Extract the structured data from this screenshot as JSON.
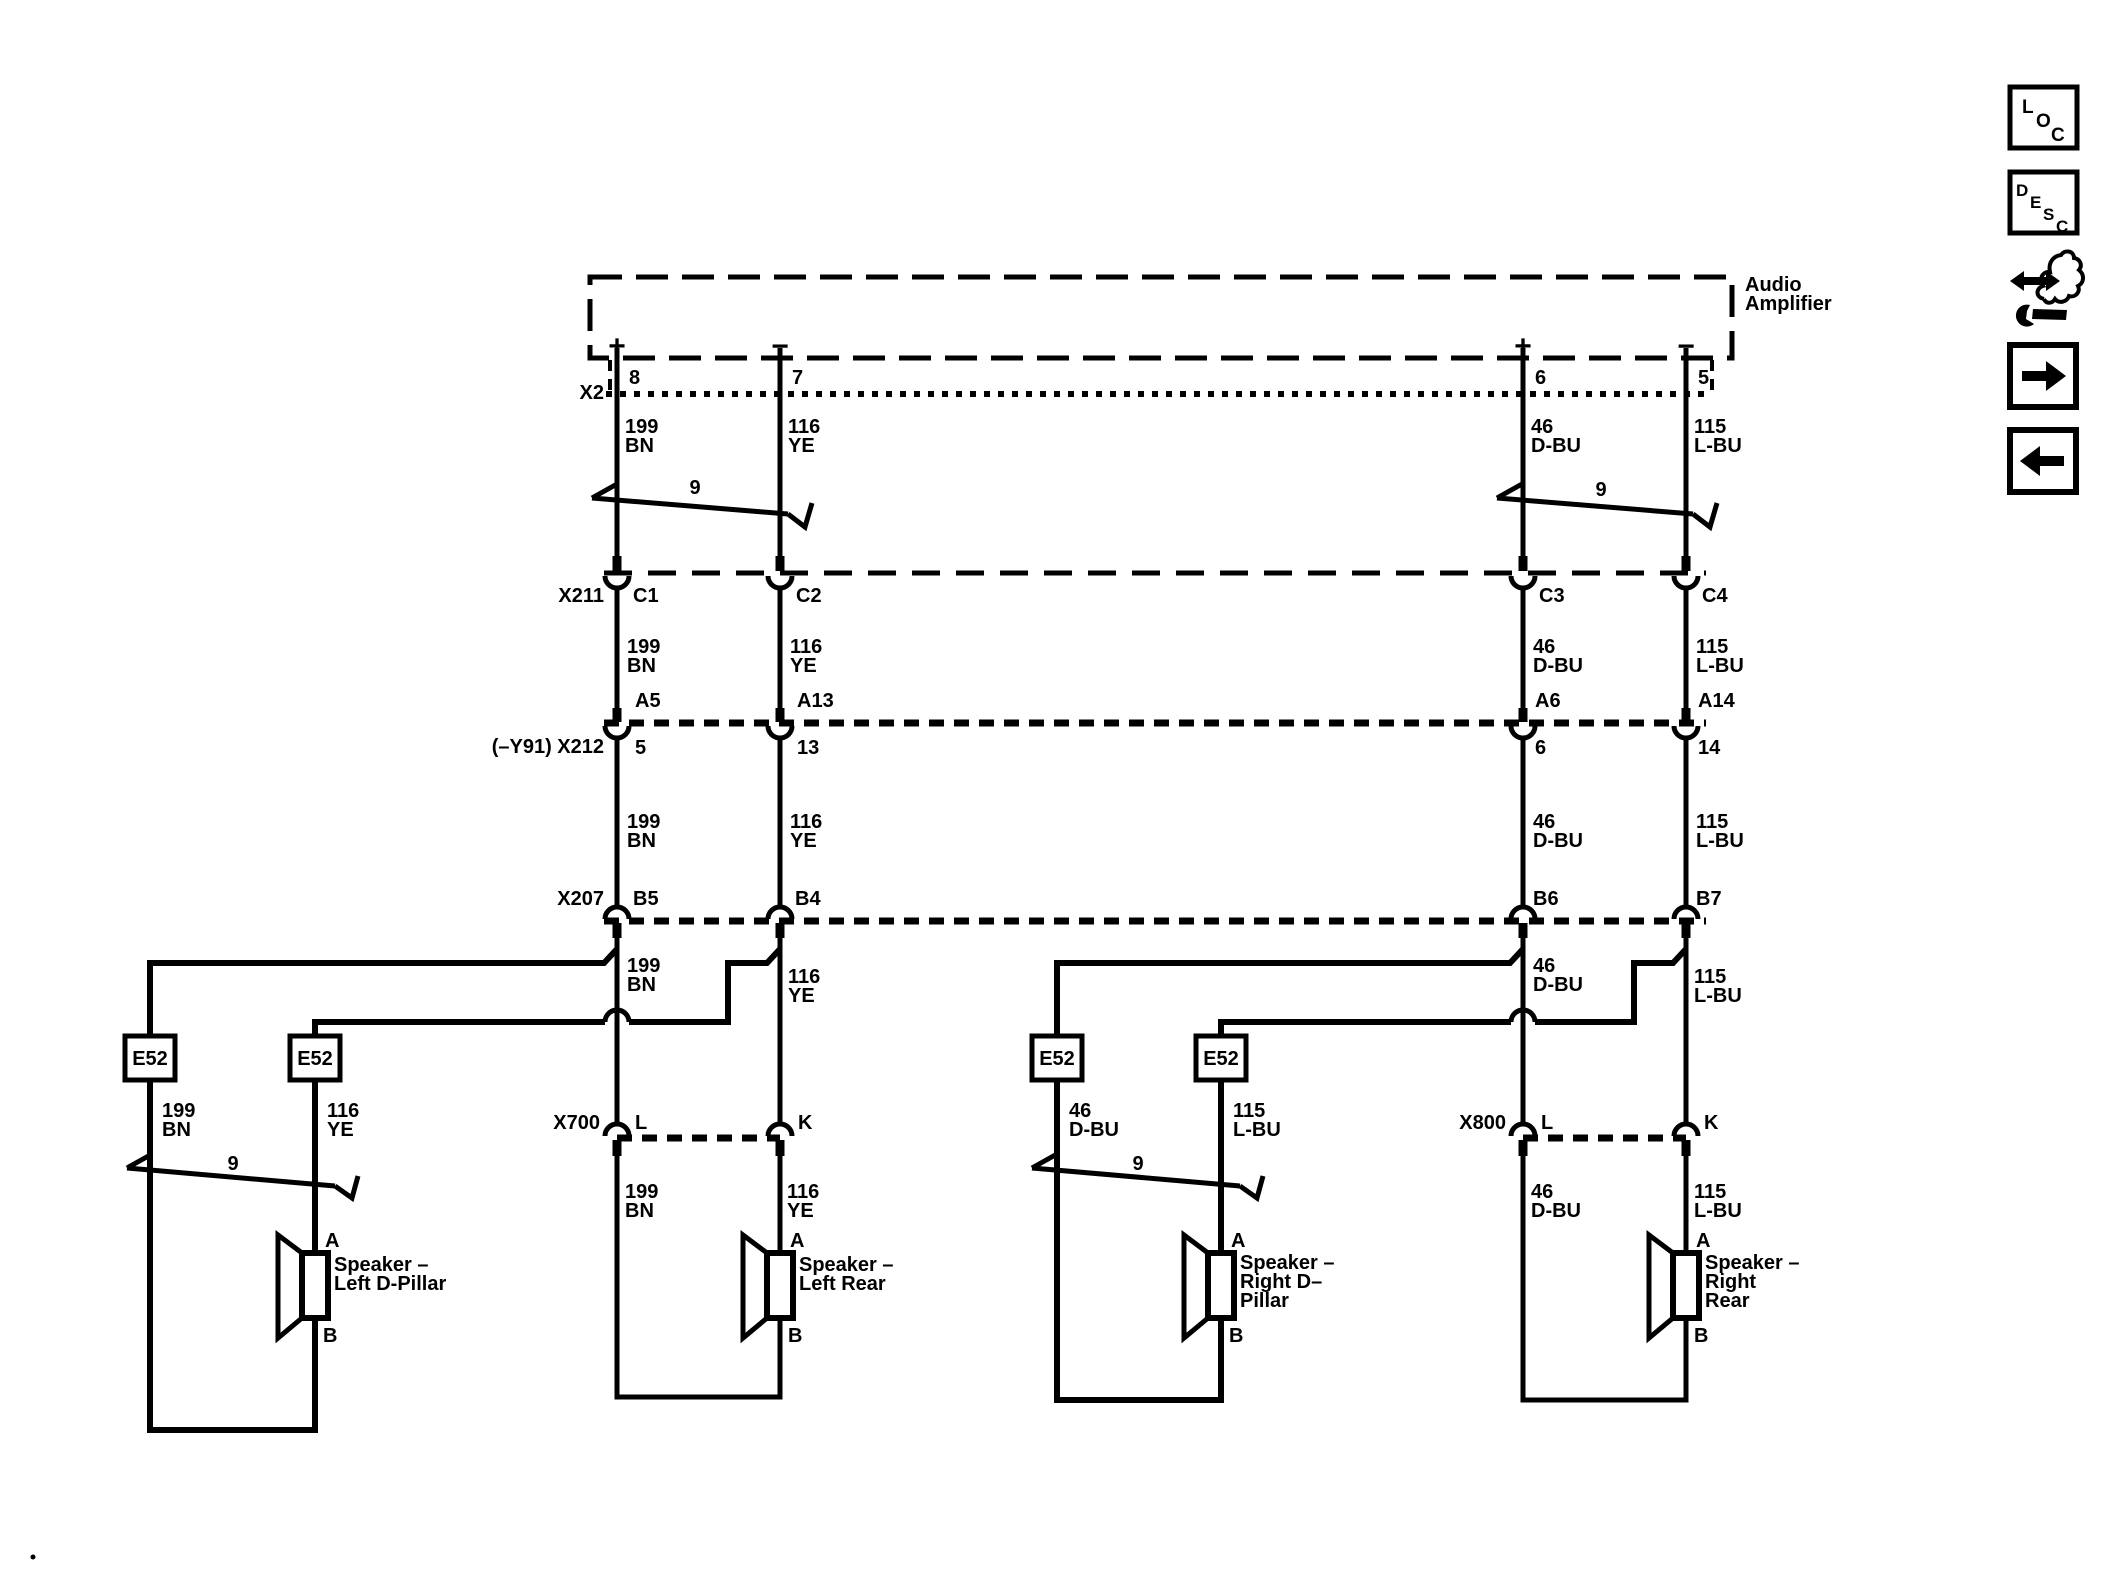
{
  "amplifier": {
    "line1": "Audio",
    "line2": "Amplifier",
    "plus": "+",
    "minus": "−"
  },
  "connectors": {
    "x2": {
      "name": "X2",
      "pins": [
        "8",
        "7",
        "6",
        "5"
      ]
    },
    "x211": {
      "name": "X211",
      "pins": [
        "C1",
        "C2",
        "C3",
        "C4"
      ]
    },
    "x212": {
      "name": "(–Y91) X212",
      "amp_pins": [
        "A5",
        "A13",
        "A6",
        "A14"
      ],
      "pins": [
        "5",
        "13",
        "6",
        "14"
      ]
    },
    "x207": {
      "name": "X207",
      "pins": [
        "B5",
        "B4",
        "B6",
        "B7"
      ]
    },
    "x700": {
      "name": "X700",
      "pins": [
        "L",
        "K"
      ]
    },
    "x800": {
      "name": "X800",
      "pins": [
        "L",
        "K"
      ]
    }
  },
  "wires": {
    "bn": {
      "id": "199",
      "color": "BN"
    },
    "ye": {
      "id": "116",
      "color": "YE"
    },
    "dbu": {
      "id": "46",
      "color": "D-BU"
    },
    "lbu": {
      "id": "115",
      "color": "L-BU"
    }
  },
  "twisted_pair_label": "9",
  "splice_label": "E52",
  "terminals": {
    "a": "A",
    "b": "B"
  },
  "speakers": {
    "left_d_pillar": {
      "line1": "Speaker –",
      "line2": "Left D-Pillar"
    },
    "left_rear": {
      "line1": "Speaker –",
      "line2": "Left Rear"
    },
    "right_d_pillar": {
      "line1": "Speaker –",
      "line2": "Right D–",
      "line3": "Pillar"
    },
    "right_rear": {
      "line1": "Speaker –",
      "line2": "Right",
      "line3": "Rear"
    }
  },
  "sidebar": {
    "loc": {
      "l1": "L",
      "l2": "O",
      "l3": "C"
    },
    "desc": {
      "l1": "D",
      "l2": "E",
      "l3": "S",
      "l4": "C"
    }
  },
  "colors": {
    "line": "#000000",
    "background": "#ffffff"
  }
}
